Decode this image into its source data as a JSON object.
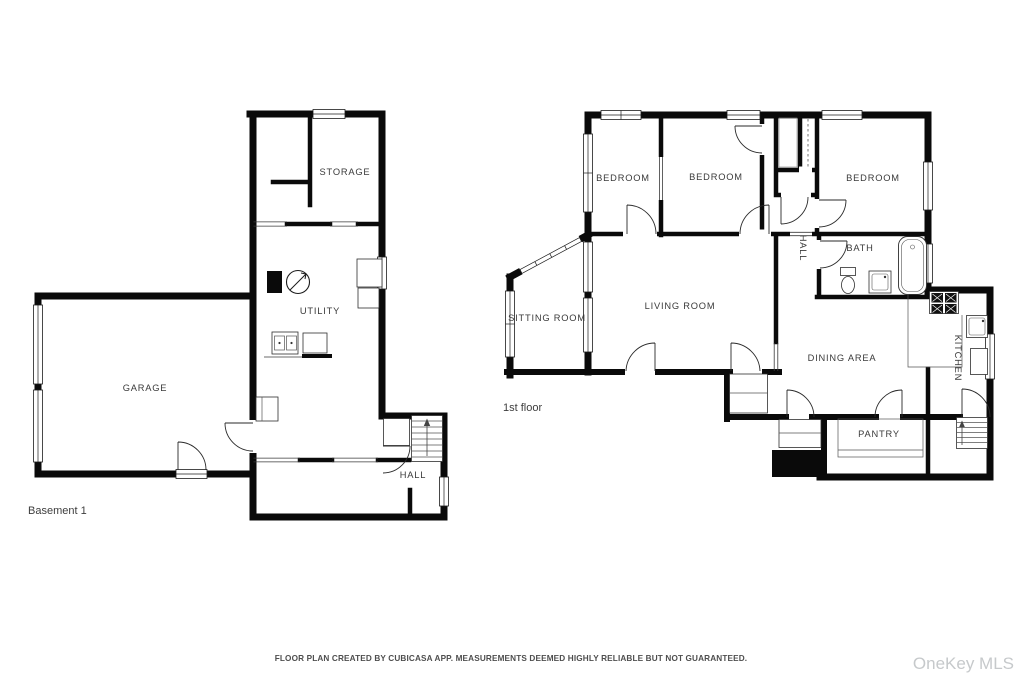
{
  "basement": {
    "floor_label": "Basement 1",
    "rooms": {
      "garage": "GARAGE",
      "storage": "STORAGE",
      "utility": "UTILITY",
      "hall": "HALL"
    }
  },
  "first_floor": {
    "floor_label": "1st floor",
    "rooms": {
      "bedroom_left": "BEDROOM",
      "bedroom_middle": "BEDROOM",
      "bedroom_right": "BEDROOM",
      "hall": "HALL",
      "bath": "BATH",
      "sitting_room": "SITTING ROOM",
      "living_room": "LIVING ROOM",
      "dining_area": "DINING AREA",
      "kitchen": "KITCHEN",
      "pantry": "PANTRY"
    }
  },
  "footer": {
    "disclaimer": "FLOOR PLAN CREATED BY CUBICASA APP. MEASUREMENTS DEEMED HIGHLY RELIABLE BUT NOT GUARANTEED."
  },
  "watermark": {
    "text": "OneKey MLS"
  },
  "colors": {
    "wall": "#0a0a0a",
    "room_label": "#3a3a3a",
    "disclaimer": "#4e4e4e",
    "watermark": "#c6c9cb",
    "background": "#ffffff"
  }
}
